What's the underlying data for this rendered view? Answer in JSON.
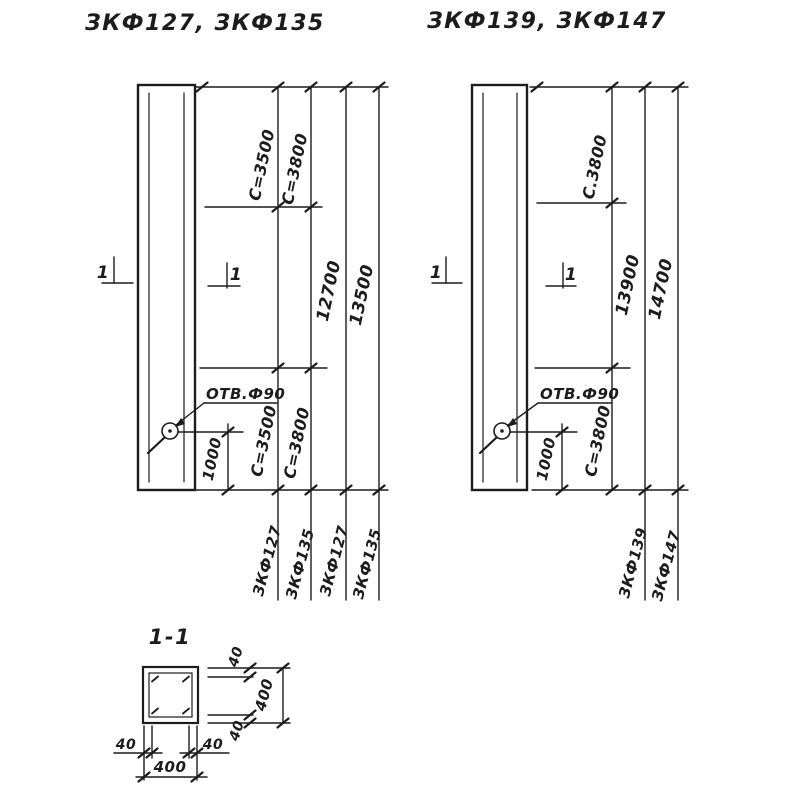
{
  "colors": {
    "ink": "#1c1c1c",
    "paper": "#ffffff"
  },
  "drawing_left": {
    "title": "ЗКФ127, ЗКФ135",
    "section_cut_label_left": "1",
    "section_cut_label_right": "1",
    "hole_label": "ОТВ.Ф90",
    "dim_c_top_a": "C=3500",
    "dim_c_top_b": "C=3800",
    "dim_length_a": "12700",
    "dim_length_b": "13500",
    "dim_hole_offset": "1000",
    "dim_c_bottom_a": "C=3500",
    "dim_c_bottom_b": "C=3800",
    "mark_a": "ЗКФ127",
    "mark_b": "ЗКФ135",
    "mark_c": "ЗКФ127",
    "mark_d": "ЗКФ135"
  },
  "drawing_right": {
    "title": "ЗКФ139, ЗКФ147",
    "section_cut_label_left": "1",
    "section_cut_label_right": "1",
    "hole_label": "ОТВ.Ф90",
    "dim_c_top": "C.3800",
    "dim_length_a": "13900",
    "dim_length_b": "14700",
    "dim_hole_offset": "1000",
    "dim_c_bottom": "C=3800",
    "mark_a": "ЗКФ139",
    "mark_b": "ЗКФ147"
  },
  "section_view": {
    "title": "1-1",
    "dim_cover_top": "40",
    "dim_height": "400",
    "dim_cover_bottom": "40",
    "dim_cover_left": "40",
    "dim_cover_right": "40",
    "dim_width": "400"
  }
}
